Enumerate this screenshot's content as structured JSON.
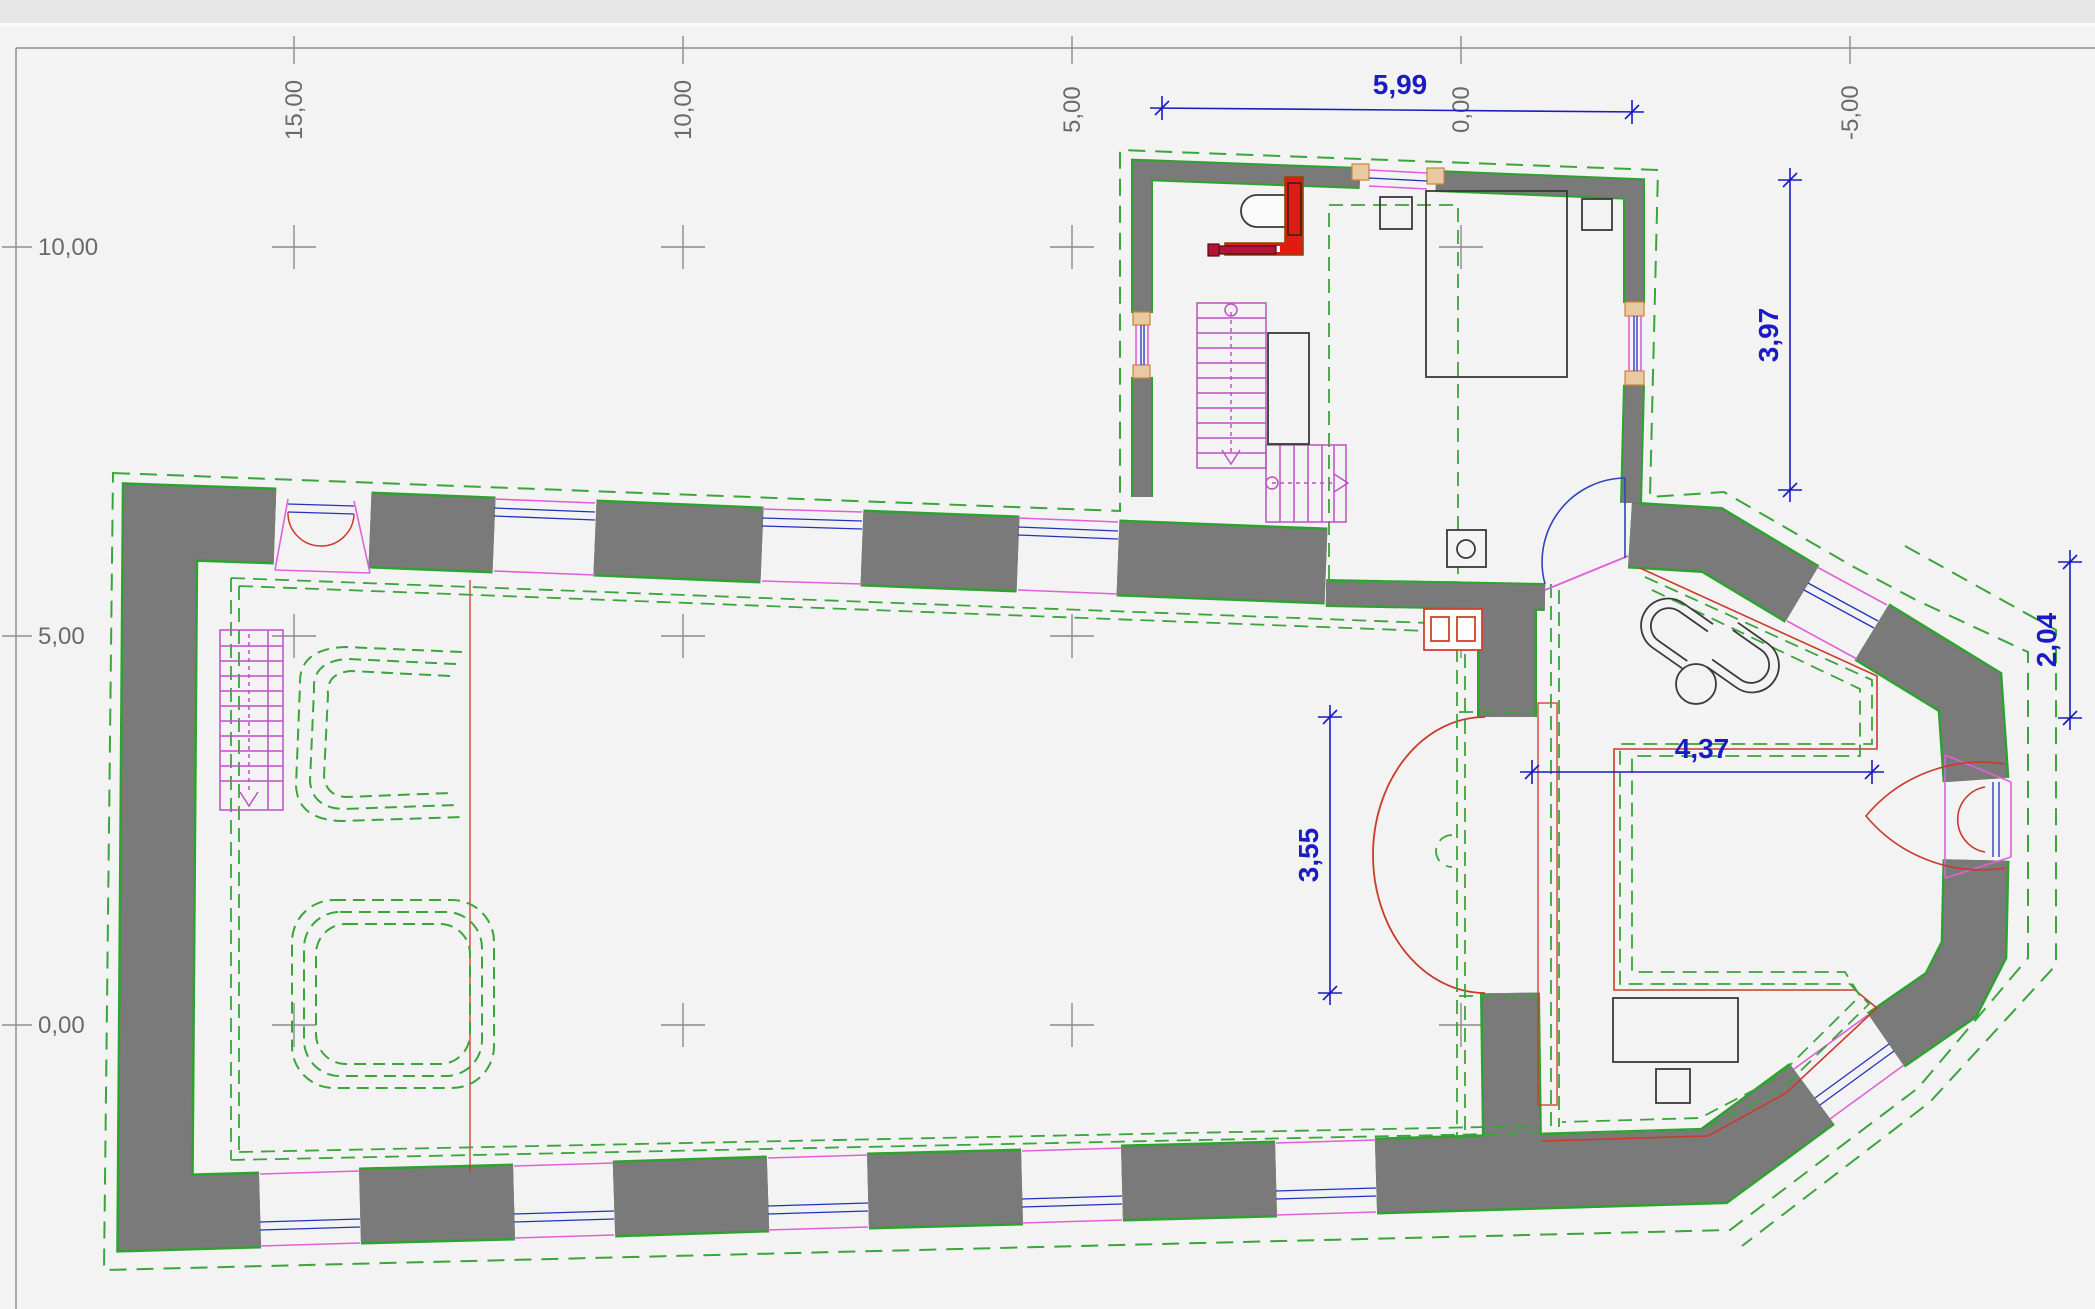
{
  "app": {
    "view": "floor-plan-canvas"
  },
  "rulers": {
    "top": [
      {
        "label": "15,00",
        "x": 294
      },
      {
        "label": "10,00",
        "x": 683
      },
      {
        "label": "5,00",
        "x": 1072
      },
      {
        "label": "0,00",
        "x": 1461
      },
      {
        "label": "-5,00",
        "x": 1850
      }
    ],
    "left": [
      {
        "label": "10,00",
        "y": 247
      },
      {
        "label": "5,00",
        "y": 636
      },
      {
        "label": "0,00",
        "y": 1025
      }
    ]
  },
  "dims": [
    {
      "id": "annex-width",
      "label": "5,99"
    },
    {
      "id": "annex-depth",
      "label": "3,97"
    },
    {
      "id": "apse-edge",
      "label": "2,04"
    },
    {
      "id": "chancel-width",
      "label": "4,37"
    },
    {
      "id": "arch-opening",
      "label": "3,55"
    }
  ],
  "colors": {
    "wall_fill": "#7a7a7a",
    "wall_edge": "#2ea22e",
    "overlay_green": "#3aa53a",
    "stair_magenta": "#c050c8",
    "window_magenta": "#e060d8",
    "window_blue": "#2233bb",
    "red": "#cc3a2a",
    "kitchen_red": "#e21b12",
    "rod_crimson": "#b01535",
    "sill_orange": "#e9c9a2",
    "dimension_blue": "#1b1bc4",
    "grid_gray": "#8a8a8a"
  }
}
